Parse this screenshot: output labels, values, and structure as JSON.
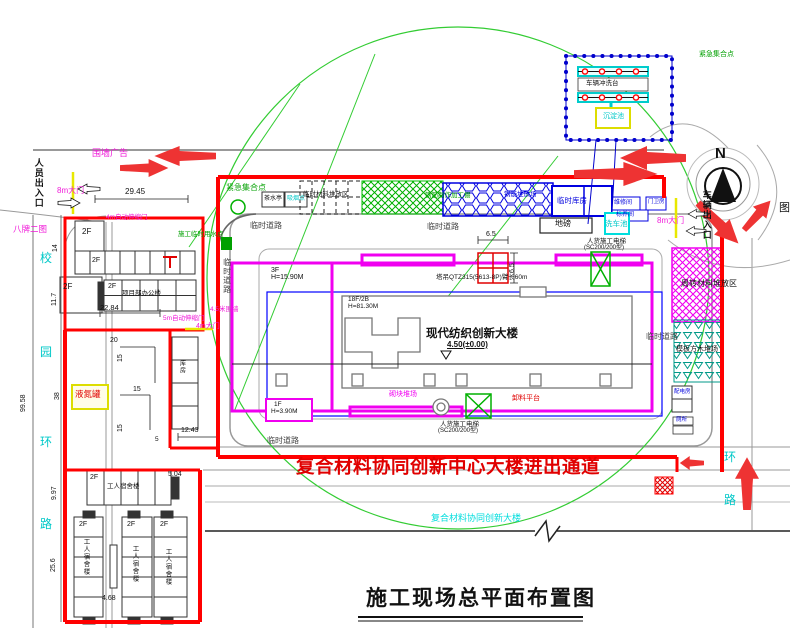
{
  "title": "施工现场总平面布置图",
  "compass_n": "N",
  "legend_partial": "图",
  "notices": {
    "access_red": "复合材料协同创新中心大楼进出通道",
    "south_building": "复合材料协同创新大楼"
  },
  "building": {
    "name": "现代纺织创新大楼",
    "elevation": "4.50(±0.00)",
    "podium_floors": "3F",
    "podium_height": "H=15.90M",
    "tower_floors": "18F/2B",
    "tower_height": "H=81.30M",
    "annex_floors": "1F",
    "annex_height": "H=3.90M"
  },
  "roads": {
    "temp_road": "临时道路",
    "campus_road": [
      "校",
      "园",
      "环",
      "路"
    ],
    "east_road": [
      "环",
      "路"
    ]
  },
  "zones": {
    "material_stack": "临时材料堆放区",
    "rebar_shed": "钢筋制作加工棚",
    "rebar_yard": "钢筋堆放场",
    "warehouse": "临时库房",
    "repair_room": "维修间",
    "curing_room": "标养间",
    "guard_room": "门卫房",
    "weighbridge": "地磅",
    "wash_pool": "洗车池",
    "turnover_yard": "周转材料堆放区",
    "formwork_yard": "模板方木堆场",
    "power_room": "配电房",
    "toilet": "厕所",
    "block_yard": "砌块堆场",
    "unload_platform": "卸料平台",
    "ln2_tank": "液氮罐",
    "storage": "库房",
    "tea_room": "茶水亭",
    "smoking_point": "吸烟点",
    "assembly_point": "紧急集合点",
    "water_point": "施工临时用水点"
  },
  "equipment": {
    "tower_crane": "塔吊QTZ315(5613-8P)臂长60m",
    "hoist_line1": "人货施工电梯",
    "hoist_line2": "(SC200/200型)",
    "wash_platform": "车辆冲洗台",
    "sediment_pool": "沉淀池"
  },
  "gates": {
    "gate8m": "8m大门",
    "gate4m": "4m大门",
    "auto_gate4m": "4m自动伸缩门",
    "auto_gate5m": "5m自动伸缩门",
    "fence_ad": "围墙广告",
    "eight_boards": "八牌二图",
    "wall45": "4.5米围墙",
    "people_entrance": "人员出入口",
    "vehicle_entrance": "车辆出入口"
  },
  "left_buildings": {
    "office": "项目部办公楼",
    "dorm": "工人宿舍楼",
    "floors2": "2F"
  },
  "dims": {
    "d2945": "29.45",
    "d2284": "22.84",
    "d1243": "12.43",
    "d468": "4.68",
    "d504": "5.04",
    "d997": "9.97",
    "d256": "25.6",
    "d9958": "99.58",
    "d14": "14",
    "d117": "11.7",
    "d38": "38",
    "d20": "20",
    "d15": "15",
    "d5": "5",
    "d65": "6.5"
  }
}
